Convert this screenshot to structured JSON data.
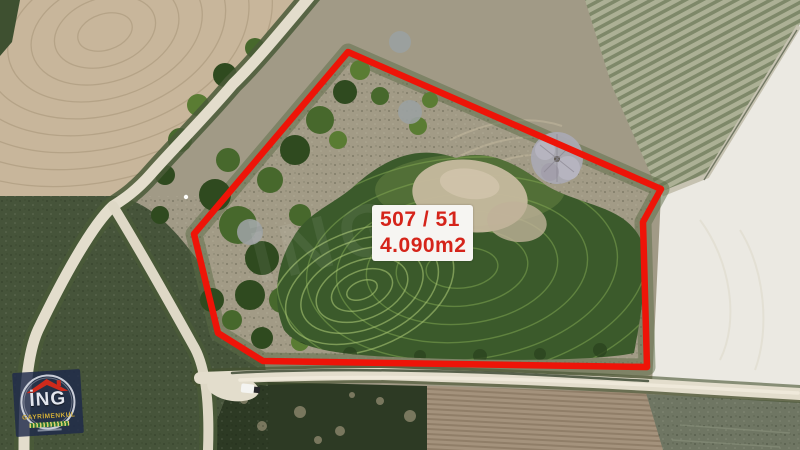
{
  "scene": {
    "watermark": "İNG"
  },
  "parcel_overlay": {
    "parcel_number": "507 / 51",
    "area": "4.090m2"
  },
  "logo": {
    "brand": "İNG",
    "subtitle": "GAYRİMENKUL",
    "icon": "roof-icon"
  },
  "colors": {
    "boundary_red": "#ee1408",
    "label_background": "#f6f5f2",
    "label_text": "#d5241a",
    "logo_navy": "#1e2a4a",
    "logo_gold": "#d4af37",
    "logo_roof_red": "#cf2a1b",
    "road": "#e3ddcc",
    "meadow_green": "#3b5a2b"
  }
}
